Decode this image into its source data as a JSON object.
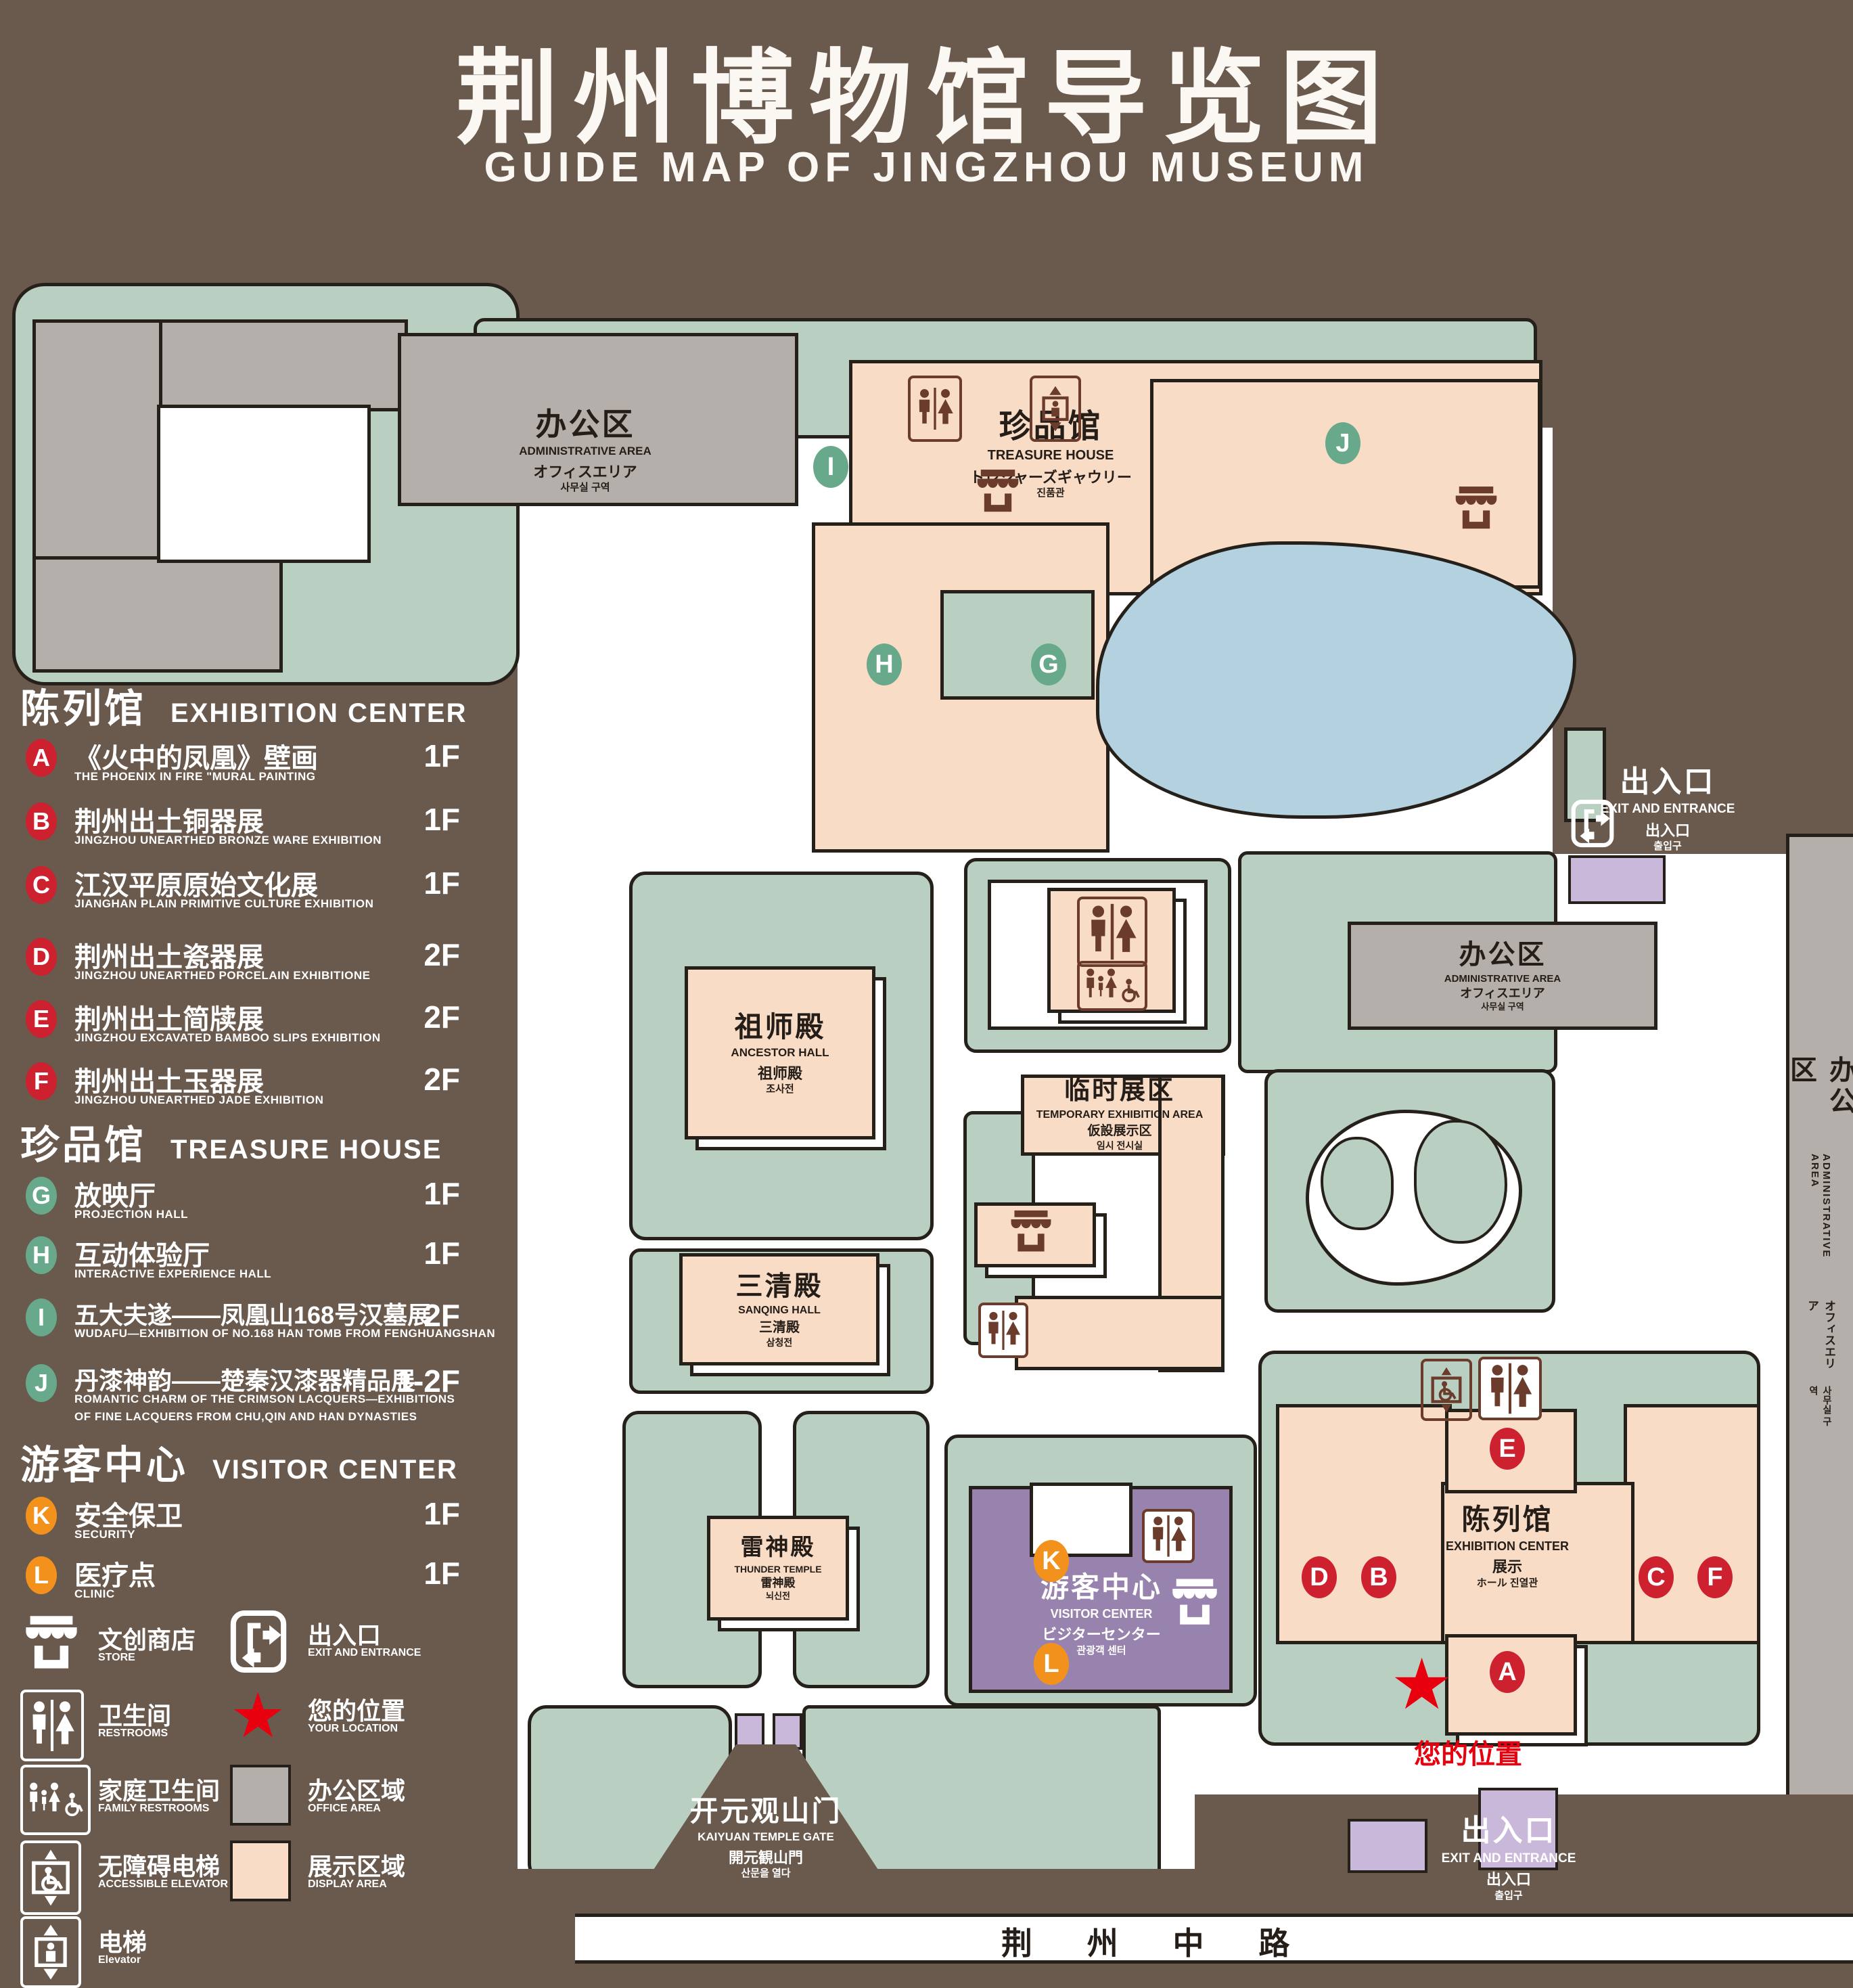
{
  "header": {
    "title_zh": "荆州博物馆导览图",
    "title_en": "GUIDE MAP OF JINGZHOU MUSEUM"
  },
  "legend": {
    "sections": [
      {
        "title_zh": "陈列馆",
        "title_en": "EXHIBITION CENTER",
        "items": [
          {
            "key": "A",
            "zh": "《火中的凤凰》壁画",
            "en": "THE PHOENIX IN FIRE \"MURAL PAINTING",
            "floor": "1F"
          },
          {
            "key": "B",
            "zh": "荆州出土铜器展",
            "en": "JINGZHOU UNEARTHED BRONZE WARE EXHIBITION",
            "floor": "1F"
          },
          {
            "key": "C",
            "zh": "江汉平原原始文化展",
            "en": "JIANGHAN PLAIN PRIMITIVE CULTURE EXHIBITION",
            "floor": "1F"
          },
          {
            "key": "D",
            "zh": "荆州出土瓷器展",
            "en": "JINGZHOU UNEARTHED PORCELAIN EXHIBITIONE",
            "floor": "2F"
          },
          {
            "key": "E",
            "zh": "荆州出土简牍展",
            "en": "JINGZHOU EXCAVATED BAMBOO SLIPS EXHIBITION",
            "floor": "2F"
          },
          {
            "key": "F",
            "zh": "荆州出土玉器展",
            "en": "JINGZHOU UNEARTHED JADE EXHIBITION",
            "floor": "2F"
          }
        ]
      },
      {
        "title_zh": "珍品馆",
        "title_en": "TREASURE HOUSE",
        "items": [
          {
            "key": "G",
            "zh": "放映厅",
            "en": "PROJECTION HALL",
            "floor": "1F"
          },
          {
            "key": "H",
            "zh": "互动体验厅",
            "en": "INTERACTIVE EXPERIENCE HALL",
            "floor": "1F"
          },
          {
            "key": "I",
            "zh": "五大夫遂——凤凰山168号汉墓展",
            "en": "WUDAFU—EXHIBITION OF NO.168 HAN TOMB FROM FENGHUANGSHAN",
            "floor": "2F"
          },
          {
            "key": "J",
            "zh": "丹漆神韵——楚秦汉漆器精品展",
            "en": "ROMANTIC CHARM OF THE CRIMSON LACQUERS—EXHIBITIONS",
            "en2": "OF FINE LACQUERS FROM CHU,QIN AND HAN DYNASTIES",
            "floor": "1-2F"
          }
        ]
      },
      {
        "title_zh": "游客中心",
        "title_en": "VISITOR CENTER",
        "items": [
          {
            "key": "K",
            "zh": "安全保卫",
            "en": "SECURITY",
            "floor": "1F"
          },
          {
            "key": "L",
            "zh": "医疗点",
            "en": "CLINIC",
            "floor": "1F"
          }
        ]
      }
    ],
    "symbols": [
      {
        "icon": "store-icon",
        "zh": "文创商店",
        "en": "STORE"
      },
      {
        "icon": "exit-icon",
        "zh": "出入口",
        "en": "EXIT AND ENTRANCE"
      },
      {
        "icon": "restroom-icon",
        "zh": "卫生间",
        "en": "RESTROOMS"
      },
      {
        "icon": "location-star-icon",
        "zh": "您的位置",
        "en": "YOUR LOCATION"
      },
      {
        "icon": "family-restroom-icon",
        "zh": "家庭卫生间",
        "en": "FAMILY RESTROOMS"
      },
      {
        "icon": "office-area-chip",
        "zh": "办公区域",
        "en": "OFFICE AREA"
      },
      {
        "icon": "accessible-elevator-icon",
        "zh": "无障碍电梯",
        "en": "ACCESSIBLE ELEVATOR"
      },
      {
        "icon": "display-area-chip",
        "zh": "展示区域",
        "en": "DISPLAY AREA"
      },
      {
        "icon": "elevator-icon",
        "zh": "电梯",
        "en": "Elevator"
      }
    ]
  },
  "map": {
    "buildings": {
      "admin_top_left": {
        "zh": "办公区",
        "en": "ADMINISTRATIVE AREA",
        "l3": "オフィスエリア",
        "l4": "사무실 구역"
      },
      "treasure_house": {
        "zh": "珍品馆",
        "en": "TREASURE HOUSE",
        "l3": "トレジャーズギャウリー",
        "l4": "진품관"
      },
      "ancestor_hall": {
        "zh": "祖师殿",
        "en": "ANCESTOR HALL",
        "l3": "祖师殿",
        "l4": "조사전"
      },
      "temporary_exhibition": {
        "zh": "临时展区",
        "en": "TEMPORARY EXHIBITION AREA",
        "l3": "仮設展示区",
        "l4": "임시 전시실"
      },
      "sanqing_hall": {
        "zh": "三清殿",
        "en": "SANQING HALL",
        "l3": "三清殿",
        "l4": "삼청전"
      },
      "thunder_temple": {
        "zh": "雷神殿",
        "en": "THUNDER TEMPLE",
        "l3": "雷神殿",
        "l4": "뇌신전"
      },
      "admin_right": {
        "zh": "办公区",
        "en": "ADMINISTRATIVE AREA",
        "l3": "オフィスエリア",
        "l4": "사무실 구역"
      },
      "admin_far_right": {
        "zh": "办公区",
        "en": "ADMINISTRATIVE AREA",
        "l3": "オフィスエリア",
        "l4": "사무실 구역"
      },
      "exhibition_center": {
        "zh": "陈列馆",
        "en": "EXHIBITION CENTER",
        "l3": "展示",
        "l4": "ホール 진열관"
      },
      "visitor_center": {
        "zh": "游客中心",
        "en": "VISITOR CENTER",
        "l3": "ビジターセンター",
        "l4": "관광객 센터"
      },
      "kaiyuan_gate": {
        "zh": "开元观山门",
        "en": "KAIYUAN TEMPLE GATE",
        "l3": "開元観山門",
        "l4": "산문을 열다"
      }
    },
    "exits": {
      "top_right": {
        "zh": "出入口",
        "en": "EXIT AND ENTRANCE",
        "l3": "出入口",
        "l4": "출입구"
      },
      "bottom_right": {
        "zh": "出入口",
        "en": "EXIT AND ENTRANCE",
        "l3": "出入口",
        "l4": "출입구"
      }
    },
    "road": {
      "name": "荆 州 中 路"
    },
    "your_location": {
      "zh": "您的位置"
    },
    "markers": {
      "A": "A",
      "B": "B",
      "C": "C",
      "D": "D",
      "E": "E",
      "F": "F",
      "G": "G",
      "H": "H",
      "I": "I",
      "J": "J",
      "K": "K",
      "L": "L"
    }
  },
  "colors": {
    "background_brown": "#6a594d",
    "lawn_green": "#b9cfc1",
    "display_peach": "#f9dcc6",
    "office_gray": "#b4afaa",
    "pond_blue": "#b4d1df",
    "visitor_purple": "#9883ae",
    "entrance_lavender": "#c9b8d9",
    "icon_brown": "#6b3b2b",
    "marker_red": "#cd2130",
    "marker_green": "#68a98b",
    "marker_orange": "#f3911d",
    "location_red": "#e8000e"
  }
}
